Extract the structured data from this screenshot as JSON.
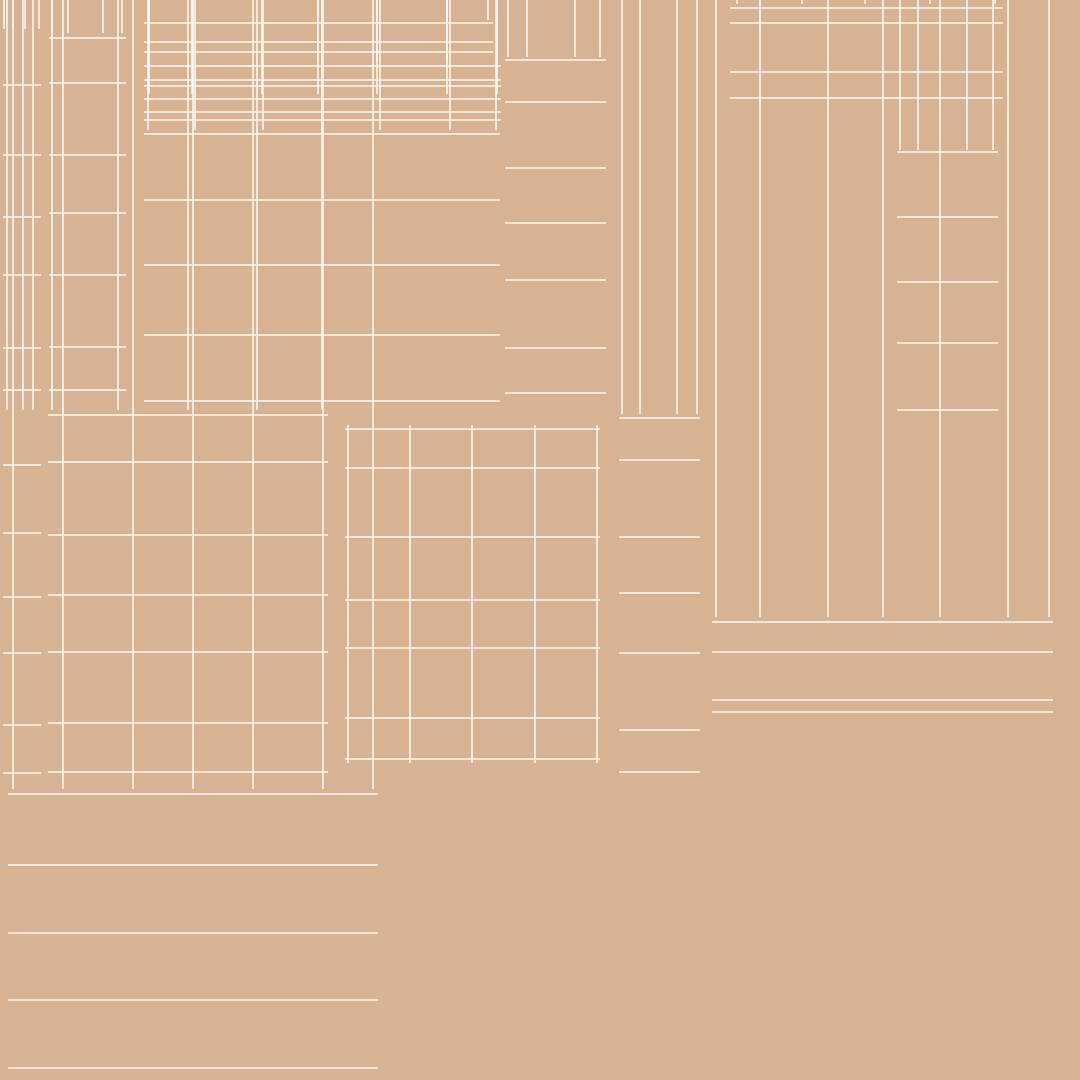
{
  "palette": {
    "background": "#d7b293",
    "outline": "#241e17",
    "inner_outline": "#342c23",
    "wire": "#faf7f1"
  },
  "atlas": {
    "canvas": {
      "width": 1080,
      "height": 1080
    },
    "islands": [
      {
        "id": "strip-top-left-a",
        "x": 1,
        "y": 27,
        "w": 42,
        "h": [
          85,
          155,
          217,
          275,
          348,
          390
        ],
        "v": [
          4,
          13,
          25,
          39
        ]
      },
      {
        "id": "strip-top-left-b",
        "x": 47,
        "y": 31,
        "w": 81,
        "h": [
          38,
          83,
          155,
          213,
          275,
          347,
          390
        ],
        "v": [
          52,
          68,
          103,
          122
        ]
      },
      {
        "id": "bar-top-1",
        "x": 142,
        "y": 18,
        "w": 353,
        "h": [
          23,
          42,
          52
        ],
        "v": [
          149,
          192,
          262,
          318,
          377,
          447,
          488
        ]
      },
      {
        "id": "bar-top-2",
        "x": 142,
        "y": 60,
        "w": 361,
        "h": [
          66,
          80,
          86
        ],
        "v": [
          149,
          192,
          262,
          318,
          377,
          447,
          497
        ]
      },
      {
        "id": "bar-top-3",
        "x": 142,
        "y": 92,
        "w": 361,
        "h": [
          99,
          112,
          120
        ],
        "v": [
          149,
          192,
          262,
          318,
          377,
          447,
          497
        ]
      },
      {
        "id": "square-top-center",
        "x": 142,
        "y": 128,
        "w": 360,
        "h": [
          134,
          200,
          265,
          335,
          401
        ],
        "v": [
          148,
          195,
          263,
          322,
          380,
          450,
          496
        ]
      },
      {
        "id": "rect-tall-center",
        "x": 503,
        "y": 55,
        "w": 105,
        "h": [
          60,
          102,
          168,
          223,
          280,
          348,
          393
        ],
        "v": [
          508,
          527,
          575,
          600
        ]
      },
      {
        "id": "bar-top-right",
        "x": 728,
        "y": 2,
        "w": 277,
        "h": [
          8,
          23,
          72,
          98
        ],
        "v": [
          737,
          802,
          865,
          930,
          995
        ]
      },
      {
        "id": "rect-right-upper",
        "x": 895,
        "y": 148,
        "w": 105,
        "h": [
          152,
          217,
          282,
          343,
          410
        ],
        "v": [
          900,
          918,
          967,
          993
        ]
      },
      {
        "id": "strip-mid-left",
        "x": 1,
        "y": 408,
        "w": 42,
        "h": [
          465,
          533,
          597,
          653,
          725,
          773
        ],
        "v": [
          7,
          23,
          33
        ]
      },
      {
        "id": "square-mid-left",
        "x": 46,
        "y": 408,
        "w": 284,
        "h": [
          415,
          462,
          535,
          595,
          652,
          723,
          772
        ],
        "v": [
          52,
          118,
          188,
          257,
          322
        ]
      },
      {
        "id": "frame-mid-center",
        "x": 333,
        "y": 413,
        "w": 279,
        "h": [
          429,
          468,
          537,
          600,
          648,
          718,
          759
        ],
        "double": true,
        "grid": {
          "x": 343,
          "y": 423,
          "w": 259,
          "h": 342
        },
        "v": [
          348,
          410,
          472,
          535,
          597
        ]
      },
      {
        "id": "strip-mid-center",
        "x": 617,
        "y": 412,
        "w": 85,
        "h": [
          418,
          460,
          537,
          593,
          653,
          730,
          772
        ],
        "v": [
          622,
          640,
          677,
          697
        ]
      },
      {
        "id": "bar-mid-right",
        "x": 710,
        "y": 615,
        "w": 345,
        "h": [
          622,
          652,
          700,
          712
        ],
        "v": [
          716,
          760,
          828,
          883,
          940,
          1008,
          1049
        ]
      },
      {
        "id": "square-bottom-left",
        "x": 6,
        "y": 787,
        "w": 374,
        "h": [
          794,
          865,
          933,
          1000,
          1068
        ],
        "v": [
          13,
          63,
          133,
          193,
          253,
          323,
          373
        ]
      },
      {
        "id": "panel-bottom-center",
        "x": 385,
        "y": 788,
        "w": 375,
        "h": 289,
        "inset": 8,
        "children": [
          {
            "id": "slat-1",
            "x": 400,
            "y": 917,
            "w": 277,
            "h": [
              925,
              937,
              944
            ],
            "v": [
              470,
              537,
              607
            ]
          },
          {
            "id": "slat-2",
            "x": 400,
            "y": 952,
            "w": 277,
            "h": [
              960,
              970,
              977
            ],
            "v": [
              470,
              537,
              607
            ]
          },
          {
            "id": "slat-3",
            "x": 400,
            "y": 987,
            "w": 290,
            "h": [
              995,
              1007,
              1018
            ],
            "v": [
              475,
              543,
              613
            ]
          },
          {
            "id": "slat-4",
            "x": 400,
            "y": 1028,
            "w": 290,
            "h": [
              1036,
              1047,
              1057
            ],
            "v": [
              475,
              543,
              613
            ]
          }
        ]
      },
      {
        "id": "frame-bottom-right",
        "x": 768,
        "y": 723,
        "w": 275,
        "h": 353,
        "double": true,
        "children": [
          {
            "id": "strip-pair-inner",
            "x": 797,
            "y": 788,
            "w": 65,
            "h": [
              795,
              862,
              928,
              992,
              1055
            ],
            "dark_v": [
              832
            ],
            "v": [
              804,
              814,
              840,
              850
            ]
          },
          {
            "id": "doors-inner",
            "x": 865,
            "y": 780,
            "w": 167,
            "h": [
              787,
              853,
              923,
              990,
              1055
            ],
            "dark_v": [
              948
            ],
            "v": [
              871,
              888,
              923,
              973,
              1008,
              1026
            ]
          }
        ]
      },
      {
        "id": "strip-right-edge",
        "x": 1043,
        "y": 723,
        "w": 40,
        "h": [
          730,
          773,
          842,
          900,
          957,
          1023,
          1068
        ],
        "v": [
          1048,
          1058,
          1070,
          1078
        ]
      },
      {
        "id": "sliver-bottom-edge",
        "x": 408,
        "y": 1078,
        "w": 37,
        "h": 10
      }
    ]
  }
}
